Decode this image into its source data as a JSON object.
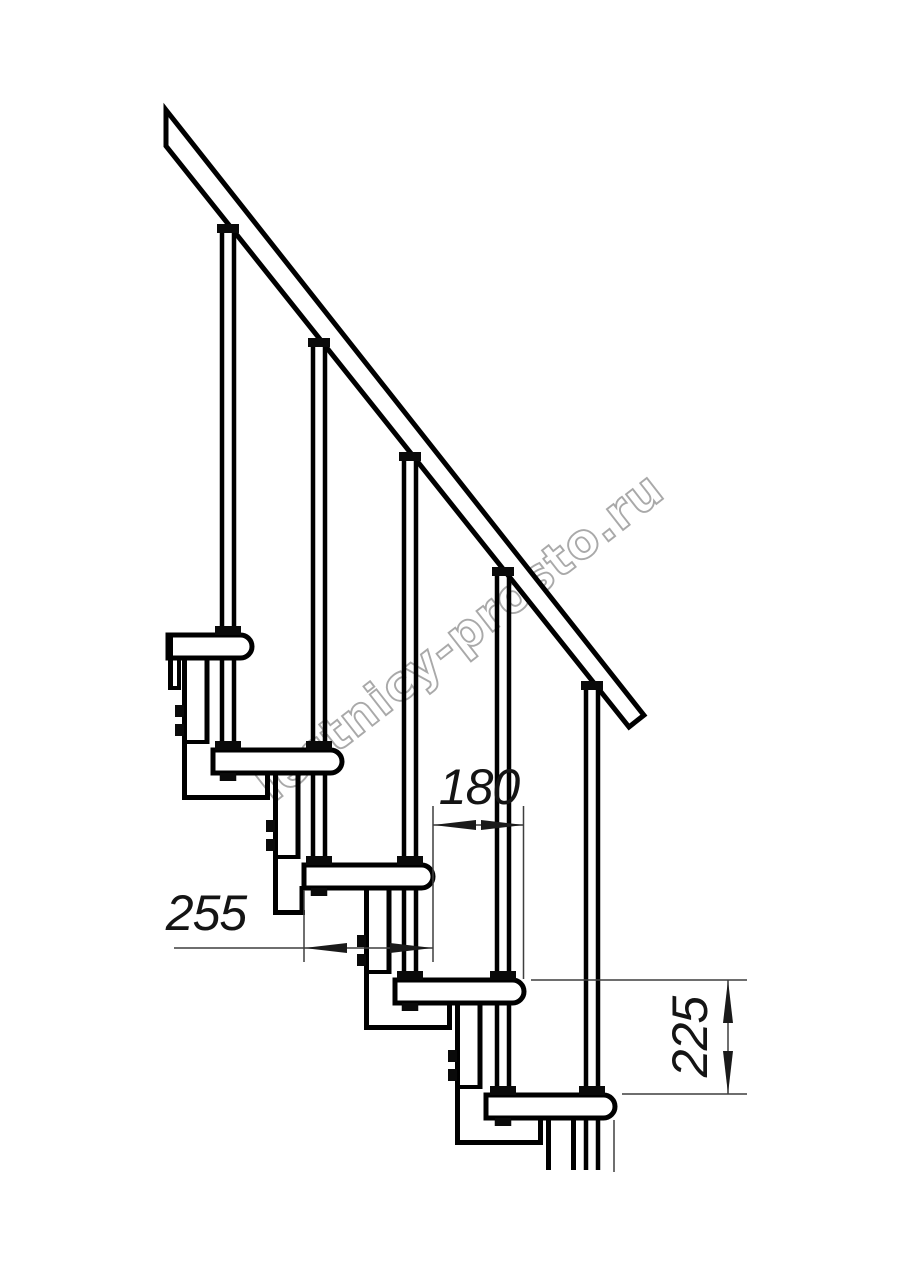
{
  "page": {
    "background": "#ffffff"
  },
  "watermark": {
    "text": "lestnicy-prosto.ru",
    "color": "#a9a9a9"
  },
  "drawing": {
    "ink_color": "#000000",
    "dim_color": "#3f3f3f",
    "dimensions": {
      "tread_depth": {
        "value": "255"
      },
      "step_run": {
        "value": "180"
      },
      "step_rise": {
        "value": "225"
      }
    }
  }
}
